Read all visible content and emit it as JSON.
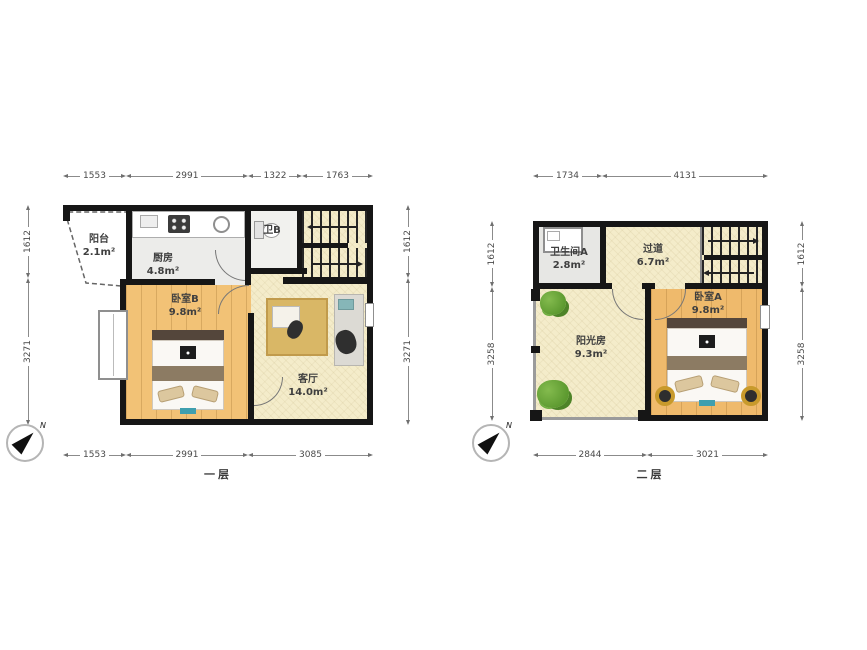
{
  "plans": [
    {
      "label": "一层",
      "compass": "N",
      "dims": {
        "top": [
          "1553",
          "2991",
          "1322",
          "1763"
        ],
        "bottom": [
          "1553",
          "2991",
          "3085"
        ],
        "left": [
          "1612",
          "3271"
        ],
        "right": [
          "1612",
          "3271"
        ]
      },
      "rooms": {
        "balcony": {
          "name": "阳台",
          "area": "2.1m²"
        },
        "kitchen": {
          "name": "厨房",
          "area": "4.8m²"
        },
        "bathB": {
          "name": "卫B",
          "area": ""
        },
        "bedroomB": {
          "name": "卧室B",
          "area": "9.8m²"
        },
        "living": {
          "name": "客厅",
          "area": "14.0m²"
        }
      }
    },
    {
      "label": "二层",
      "compass": "N",
      "dims": {
        "top": [
          "1734",
          "4131"
        ],
        "bottom": [
          "2844",
          "3021"
        ],
        "left": [
          "1612",
          "3258"
        ],
        "right": [
          "1612",
          "3258"
        ]
      },
      "rooms": {
        "bathA": {
          "name": "卫生间A",
          "area": "2.8m²"
        },
        "hallway": {
          "name": "过道",
          "area": "6.7m²"
        },
        "sunroom": {
          "name": "阳光房",
          "area": "9.3m²"
        },
        "bedroomA": {
          "name": "卧室A",
          "area": "9.8m²"
        }
      }
    }
  ],
  "colors": {
    "wall": "#161616",
    "wood": "#f2c276",
    "cream": "#f4ecca",
    "plant": "#5d9a30"
  }
}
